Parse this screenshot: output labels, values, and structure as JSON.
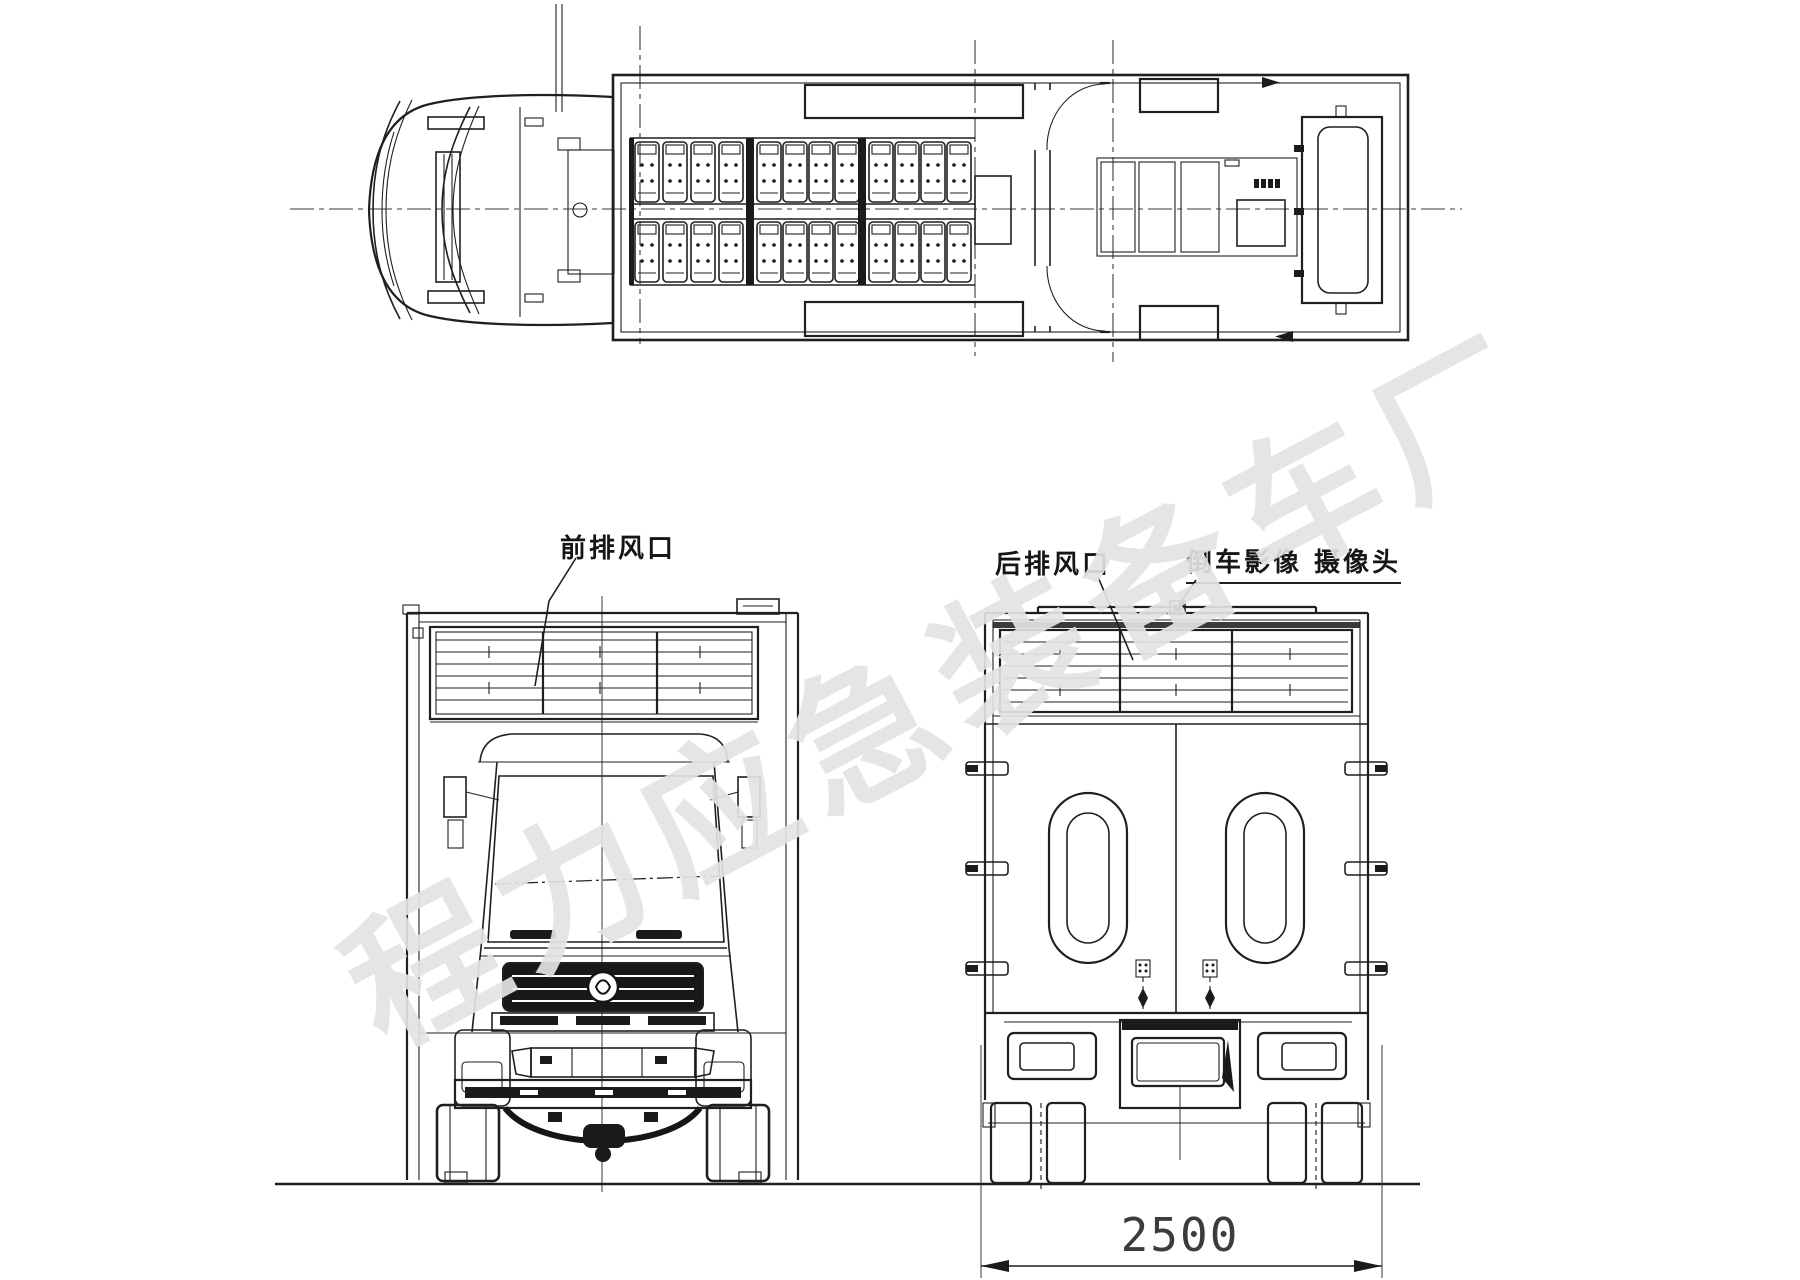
{
  "labels": {
    "front_vent": "前排风口",
    "rear_vent": "后排风口",
    "reversing_camera": "倒车影像 摄像头"
  },
  "dimensions": {
    "overall_width": "2500"
  },
  "watermark": {
    "text": "程力应急装备车厂"
  },
  "colors": {
    "line": "#1f1f1f",
    "background": "#ffffff",
    "watermark": "#e3e3e3"
  }
}
